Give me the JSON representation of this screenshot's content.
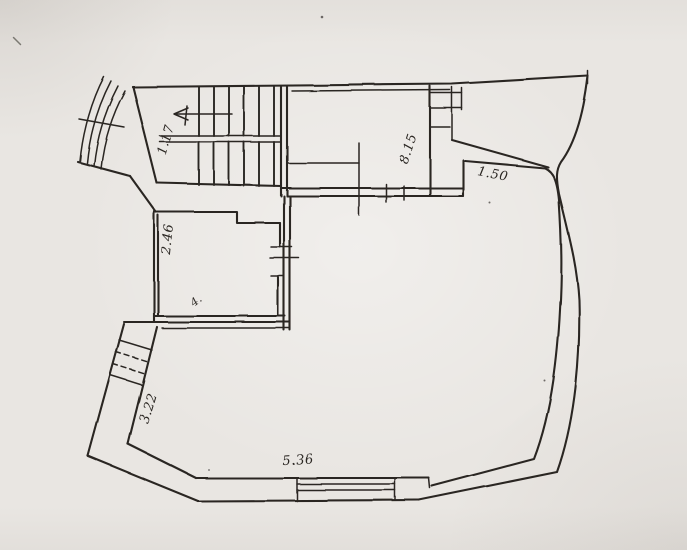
{
  "colors": {
    "paper": "#e9e6e2",
    "paper_shade": "#dcd8d2",
    "ink": "#2b2723"
  },
  "plan": {
    "dimensions": {
      "stairs": "1.17",
      "upper_room": "8.15",
      "curved_wall": "1.50",
      "side_room": "2.46",
      "side_room_note": "4.",
      "entrance": "3.22",
      "bottom_wall": "5.36"
    }
  }
}
